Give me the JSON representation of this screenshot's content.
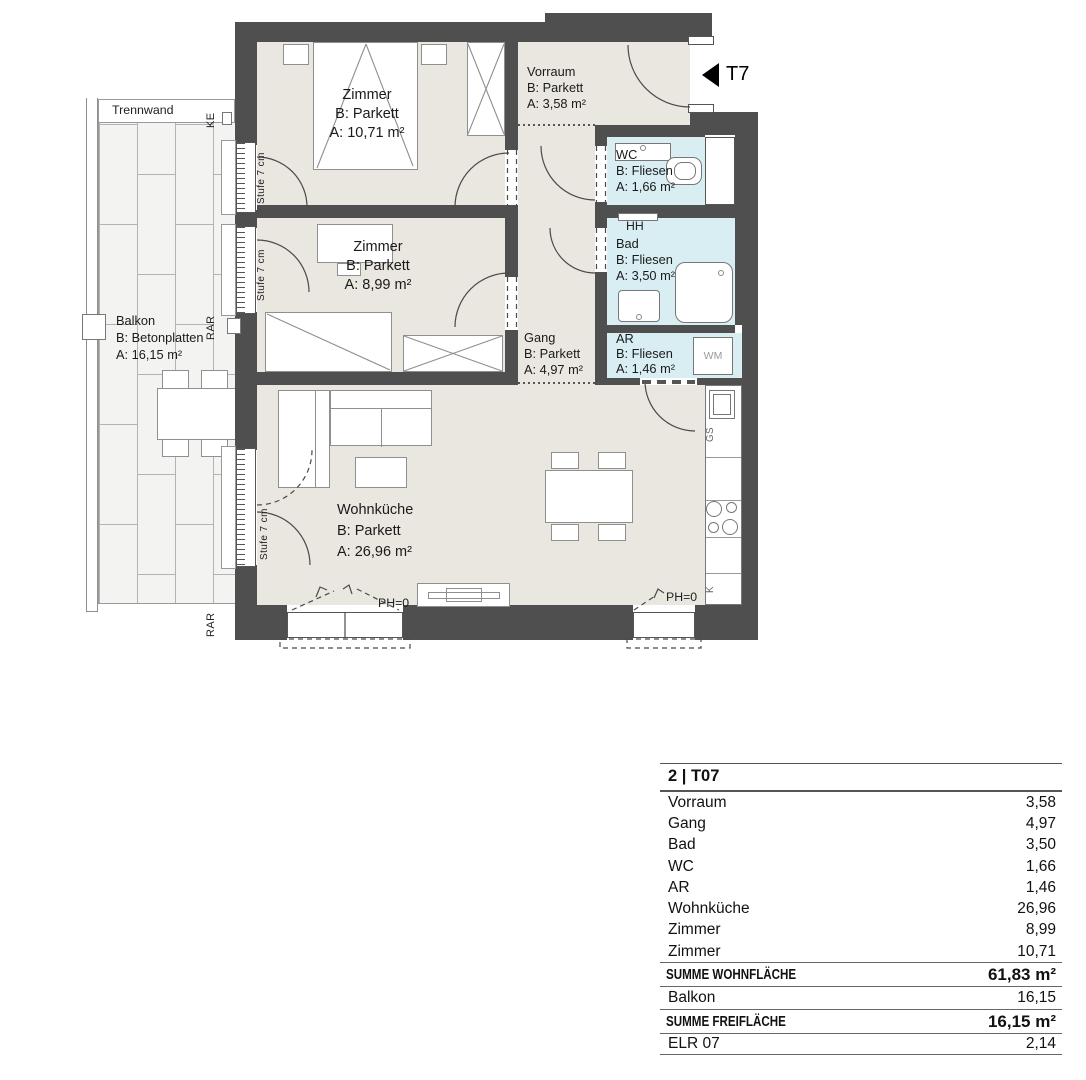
{
  "plan": {
    "labels": {
      "trennwand": "Trennwand",
      "ke": "KE",
      "rar": "RAR",
      "stufe": "Stufe 7 cm",
      "t7": "T7",
      "hh": "HH",
      "wm": "WM",
      "gs": "GS",
      "k": "K",
      "ph0": "PH=0"
    },
    "rooms": {
      "zimmer1": {
        "name": "Zimmer",
        "floor": "B: Parkett",
        "area": "A: 10,71 m²"
      },
      "zimmer2": {
        "name": "Zimmer",
        "floor": "B: Parkett",
        "area": "A: 8,99 m²"
      },
      "vorraum": {
        "name": "Vorraum",
        "floor": "B: Parkett",
        "area": "A: 3,58 m²"
      },
      "gang": {
        "name": "Gang",
        "floor": "B: Parkett",
        "area": "A: 4,97 m²"
      },
      "wc": {
        "name": "WC",
        "floor": "B: Fliesen",
        "area": "A: 1,66 m²"
      },
      "bad": {
        "name": "Bad",
        "floor": "B: Fliesen",
        "area": "A: 3,50 m²"
      },
      "ar": {
        "name": "AR",
        "floor": "B: Fliesen",
        "area": "A: 1,46 m²"
      },
      "wohnkueche": {
        "name": "Wohnküche",
        "floor": "B: Parkett",
        "area": "A: 26,96 m²"
      },
      "balkon": {
        "name": "Balkon",
        "floor": "B: Betonplatten",
        "area": "A: 16,15 m²"
      }
    },
    "colors": {
      "wall": "#4f4f4f",
      "floor_living": "#eae6e0",
      "floor_wet": "#d9eef3",
      "balcony_tile": "#f3f3f1"
    }
  },
  "table": {
    "title": "2 | T07",
    "rows": [
      {
        "label": "Vorraum",
        "value": "3,58"
      },
      {
        "label": "Gang",
        "value": "4,97"
      },
      {
        "label": "Bad",
        "value": "3,50"
      },
      {
        "label": "WC",
        "value": "1,66"
      },
      {
        "label": "AR",
        "value": "1,46"
      },
      {
        "label": "Wohnküche",
        "value": "26,96"
      },
      {
        "label": "Zimmer",
        "value": "8,99"
      },
      {
        "label": "Zimmer",
        "value": "10,71"
      }
    ],
    "sum_living": {
      "label": "SUMME WOHNFLÄCHE",
      "value": "61,83 m²"
    },
    "balkon_row": {
      "label": "Balkon",
      "value": "16,15"
    },
    "sum_open": {
      "label": "SUMME FREIFLÄCHE",
      "value": "16,15 m²"
    },
    "elr_row": {
      "label": "ELR 07",
      "value": "2,14"
    }
  }
}
